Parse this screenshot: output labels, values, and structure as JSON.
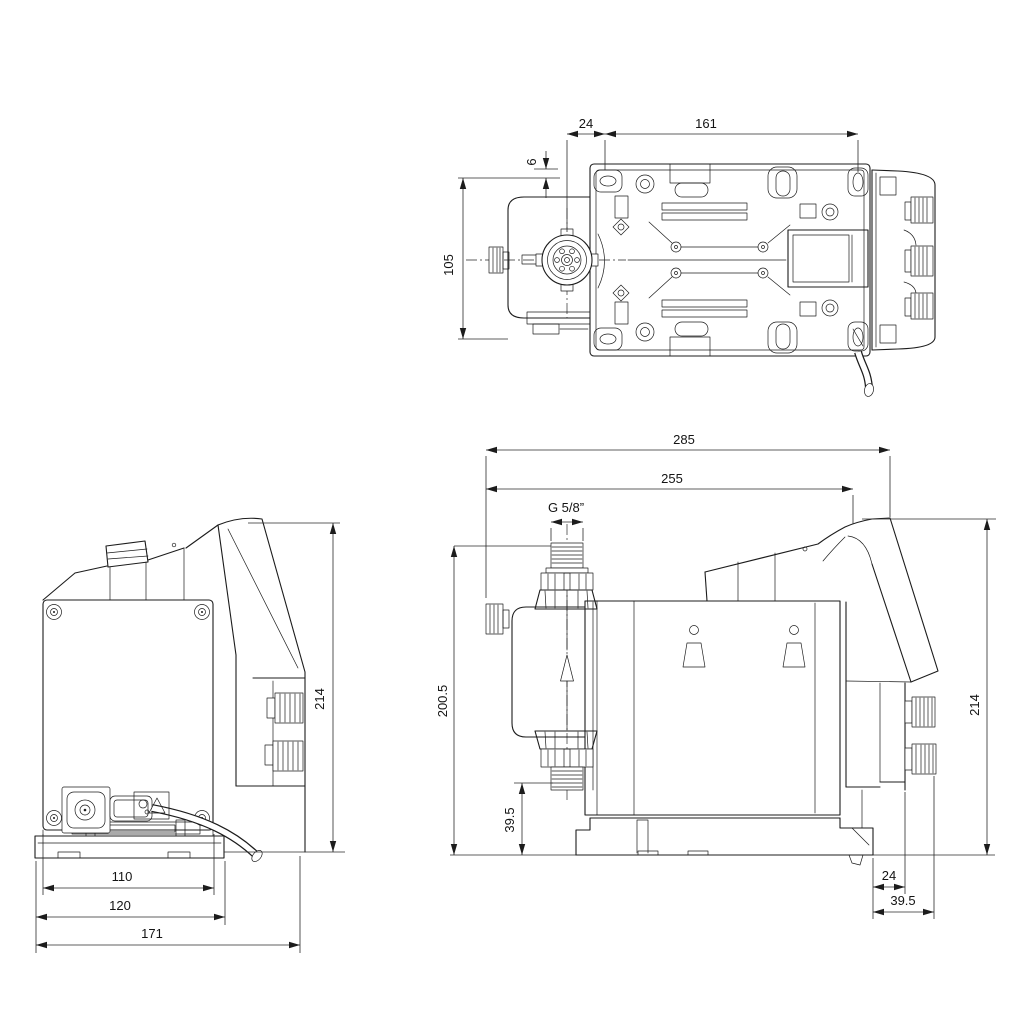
{
  "drawing": {
    "type": "technical-dimensional-drawing",
    "subject": "dosing pump, three orthographic views",
    "background_color": "#ffffff",
    "line_color": "#1c1c1c",
    "views": {
      "top": {
        "title": "top view",
        "dims": {
          "head_center_to_hole": "24",
          "hole_spacing": "161",
          "edge_offset": "6",
          "body_width": "105"
        }
      },
      "back": {
        "title": "back view",
        "dims": {
          "panel_width": "110",
          "base_width": "120",
          "overall_width": "171",
          "overall_height": "214"
        }
      },
      "side": {
        "title": "side view",
        "dims": {
          "overall_length": "285",
          "length_to_panel": "255",
          "thread_size": "G 5/8”",
          "height_to_connector": "200.5",
          "connector_clearance": "39.5",
          "overall_height": "214",
          "rear_offset": "24",
          "rear_clearance": "39.5"
        }
      }
    }
  }
}
